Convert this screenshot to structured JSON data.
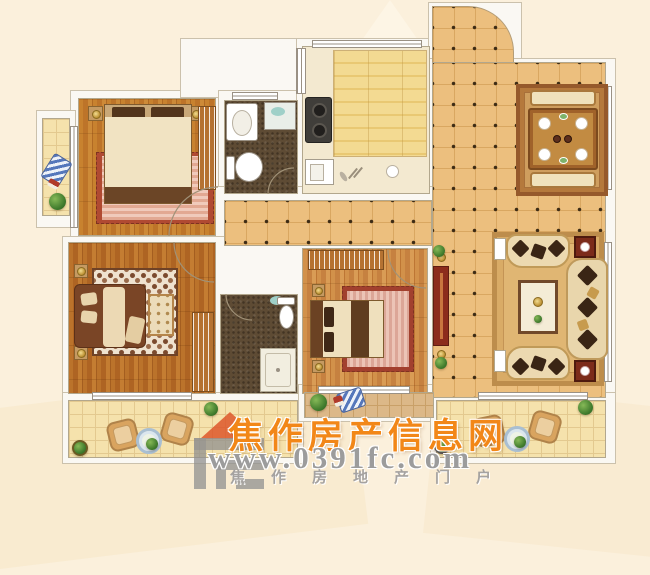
{
  "image_type": "apartment-floor-plan-rendering",
  "watermark": {
    "site_name": "焦作房产信息网",
    "site_url": "www.0391fc.com",
    "tagline": "焦作房地产门户"
  },
  "palette": {
    "background": "#fbf0dc",
    "wall": "#faf8f3",
    "wall_line": "#b2a78d",
    "hall_tile": "#ecbf7e",
    "tile_dot": "#3e2c15",
    "wood_floor": "#c8822f",
    "balcony_tile": "#f5e2ac",
    "bath_mosaic": "#5e4b34",
    "kitchen_floor": "#f3da92",
    "rug_red": "#a8442f",
    "rug_tan": "#d9ab66",
    "tv_cabinet_red": "#8c2c1c",
    "watermark_orange": "#f28718",
    "watermark_gray": "#9c9c9c"
  },
  "plan": {
    "rooms": [
      "entry-hall",
      "kitchen",
      "main-bathroom",
      "master-bedroom",
      "west-balcony",
      "dining-area",
      "living-room",
      "second-bedroom",
      "second-bathroom",
      "third-bedroom",
      "south-balcony-left",
      "south-balcony-right",
      "service-alcove"
    ]
  }
}
